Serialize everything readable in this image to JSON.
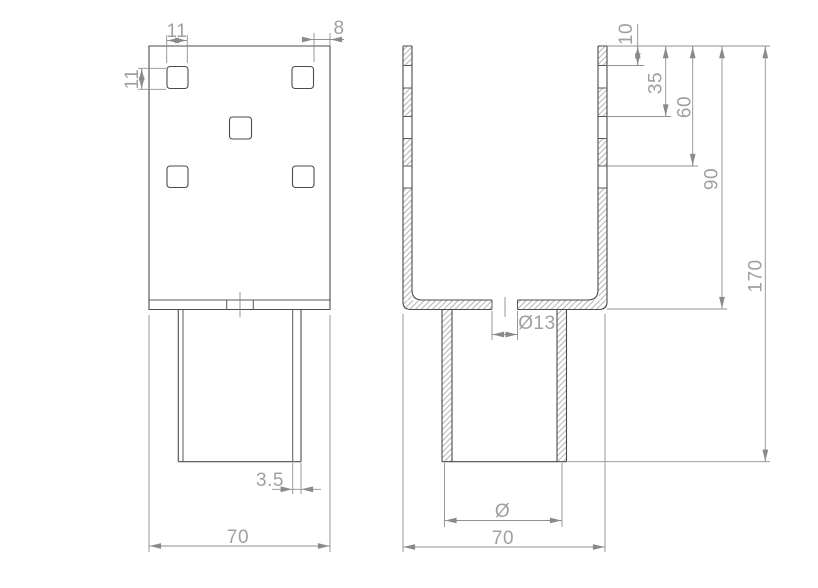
{
  "drawing": {
    "description": "Two-view technical drawing of a U-shaped post support bracket with square holes and round tube",
    "dims": {
      "hole_width": "11",
      "corner_offset": "8",
      "hole_height": "11",
      "tube_wall": "3.5",
      "front_width": "70",
      "hole_top_offset": "10",
      "hole_row2_offset": "35",
      "hole_row3_offset": "60",
      "channel_height": "90",
      "overall_height": "170",
      "base_hole_dia": "Ø13",
      "tube_dia": "Ø",
      "side_width": "70"
    }
  }
}
